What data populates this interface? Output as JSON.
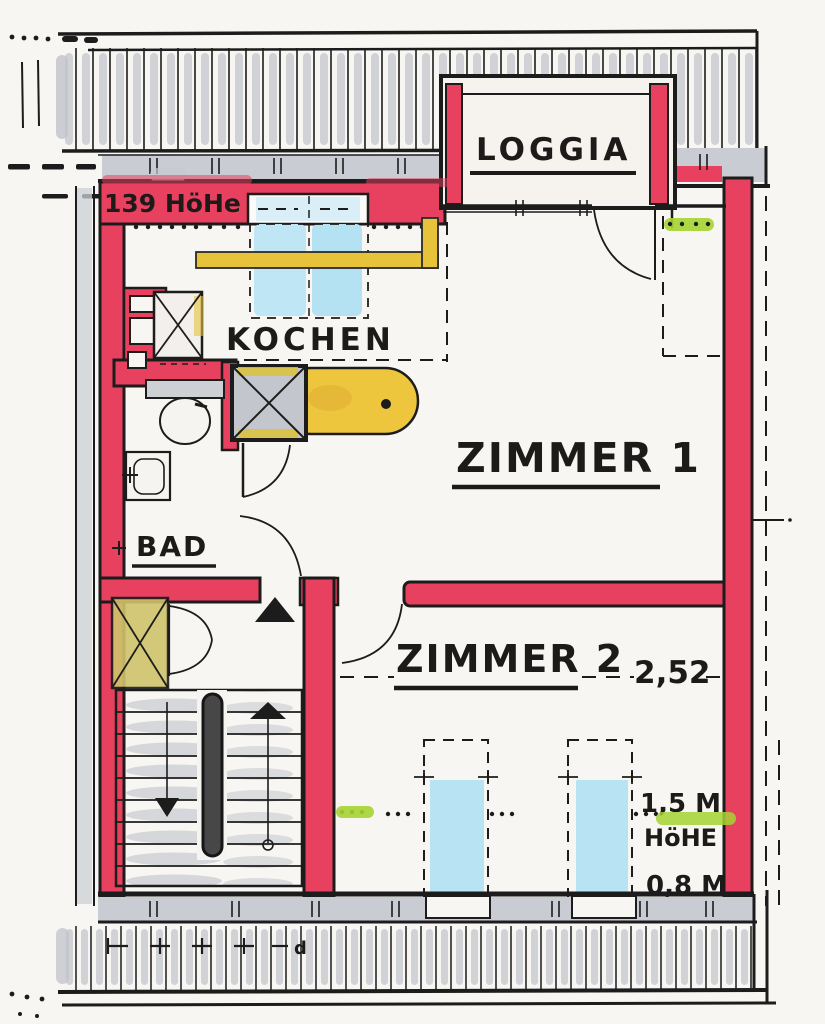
{
  "drawing": {
    "type": "hand-drawn floor plan (attic apartment)",
    "rooms": {
      "loggia": "LOGGIA",
      "kitchen": "KOCHEN",
      "room1": "ZIMMER 1",
      "room2": "ZIMMER 2",
      "bath": "BAD"
    },
    "dimensions": {
      "top_height": "139 HöHe",
      "room2_width": "2,52",
      "window_height": "1,5 M",
      "window_height_label": "HöHE",
      "sill_height": "0,8 M",
      "section_mark": "d"
    },
    "colors": {
      "wall_red": "#e8405f",
      "ink_black": "#1d1b1a",
      "marker_gray": "#c9ccd2",
      "window_blue": "#bfe6f4",
      "counter_yellow": "#e7c33c",
      "shaft_olive": "#cdc266",
      "highlight_green": "#a5d433",
      "paper": "#f8f6f2"
    }
  }
}
